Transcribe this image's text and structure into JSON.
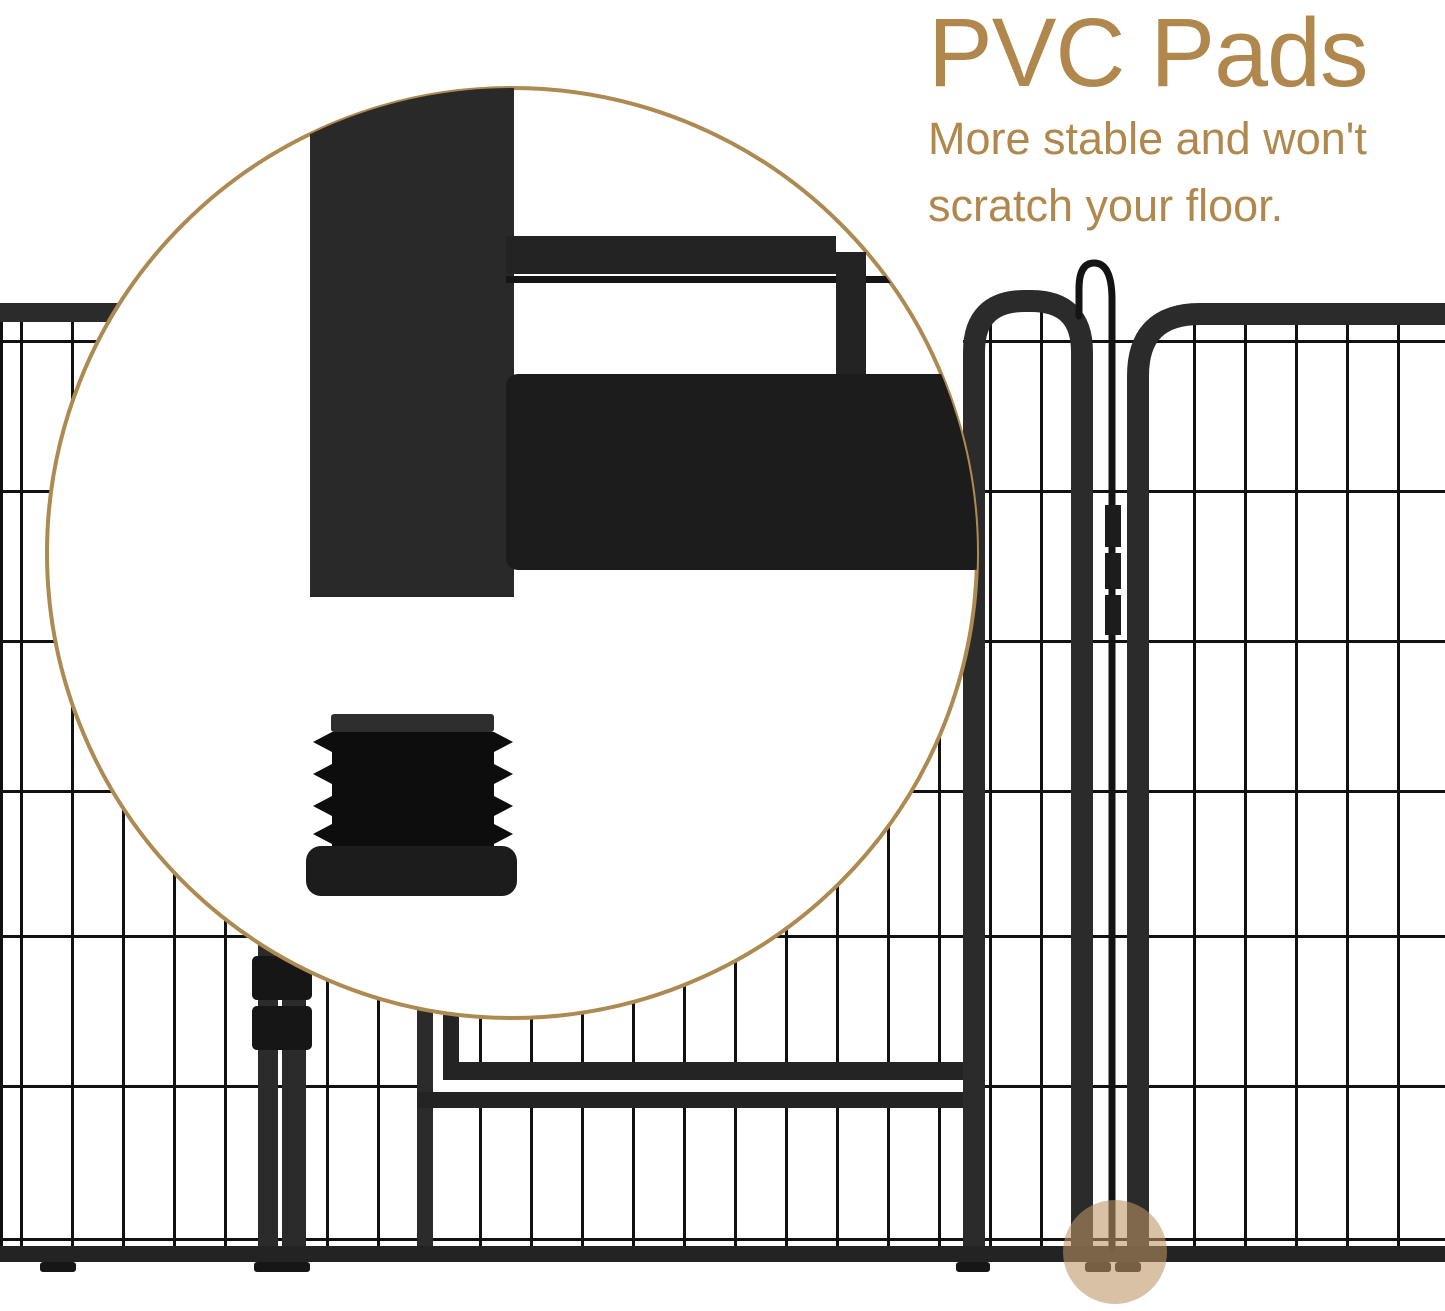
{
  "page": {
    "kind": "product-feature-graphic",
    "background": "#ffffff",
    "width": 1445,
    "height": 1311
  },
  "callout": {
    "title": "PVC Pads",
    "subtitle_lines": [
      "More stable and won't",
      "scratch your floor."
    ],
    "text_color": "#b0884e"
  },
  "magnifier": {
    "border_color": "#ad8a52",
    "fill": "#ffffff"
  },
  "highlight": {
    "color": "#bd9464",
    "opacity": 0.58
  },
  "illustration": {
    "wire_color": "#111111",
    "frame_color": "#2b2b2b",
    "pad_color": "#0d0d0d",
    "subject": "metal playpen panels with gate, latch hook and PVC foot pads"
  }
}
